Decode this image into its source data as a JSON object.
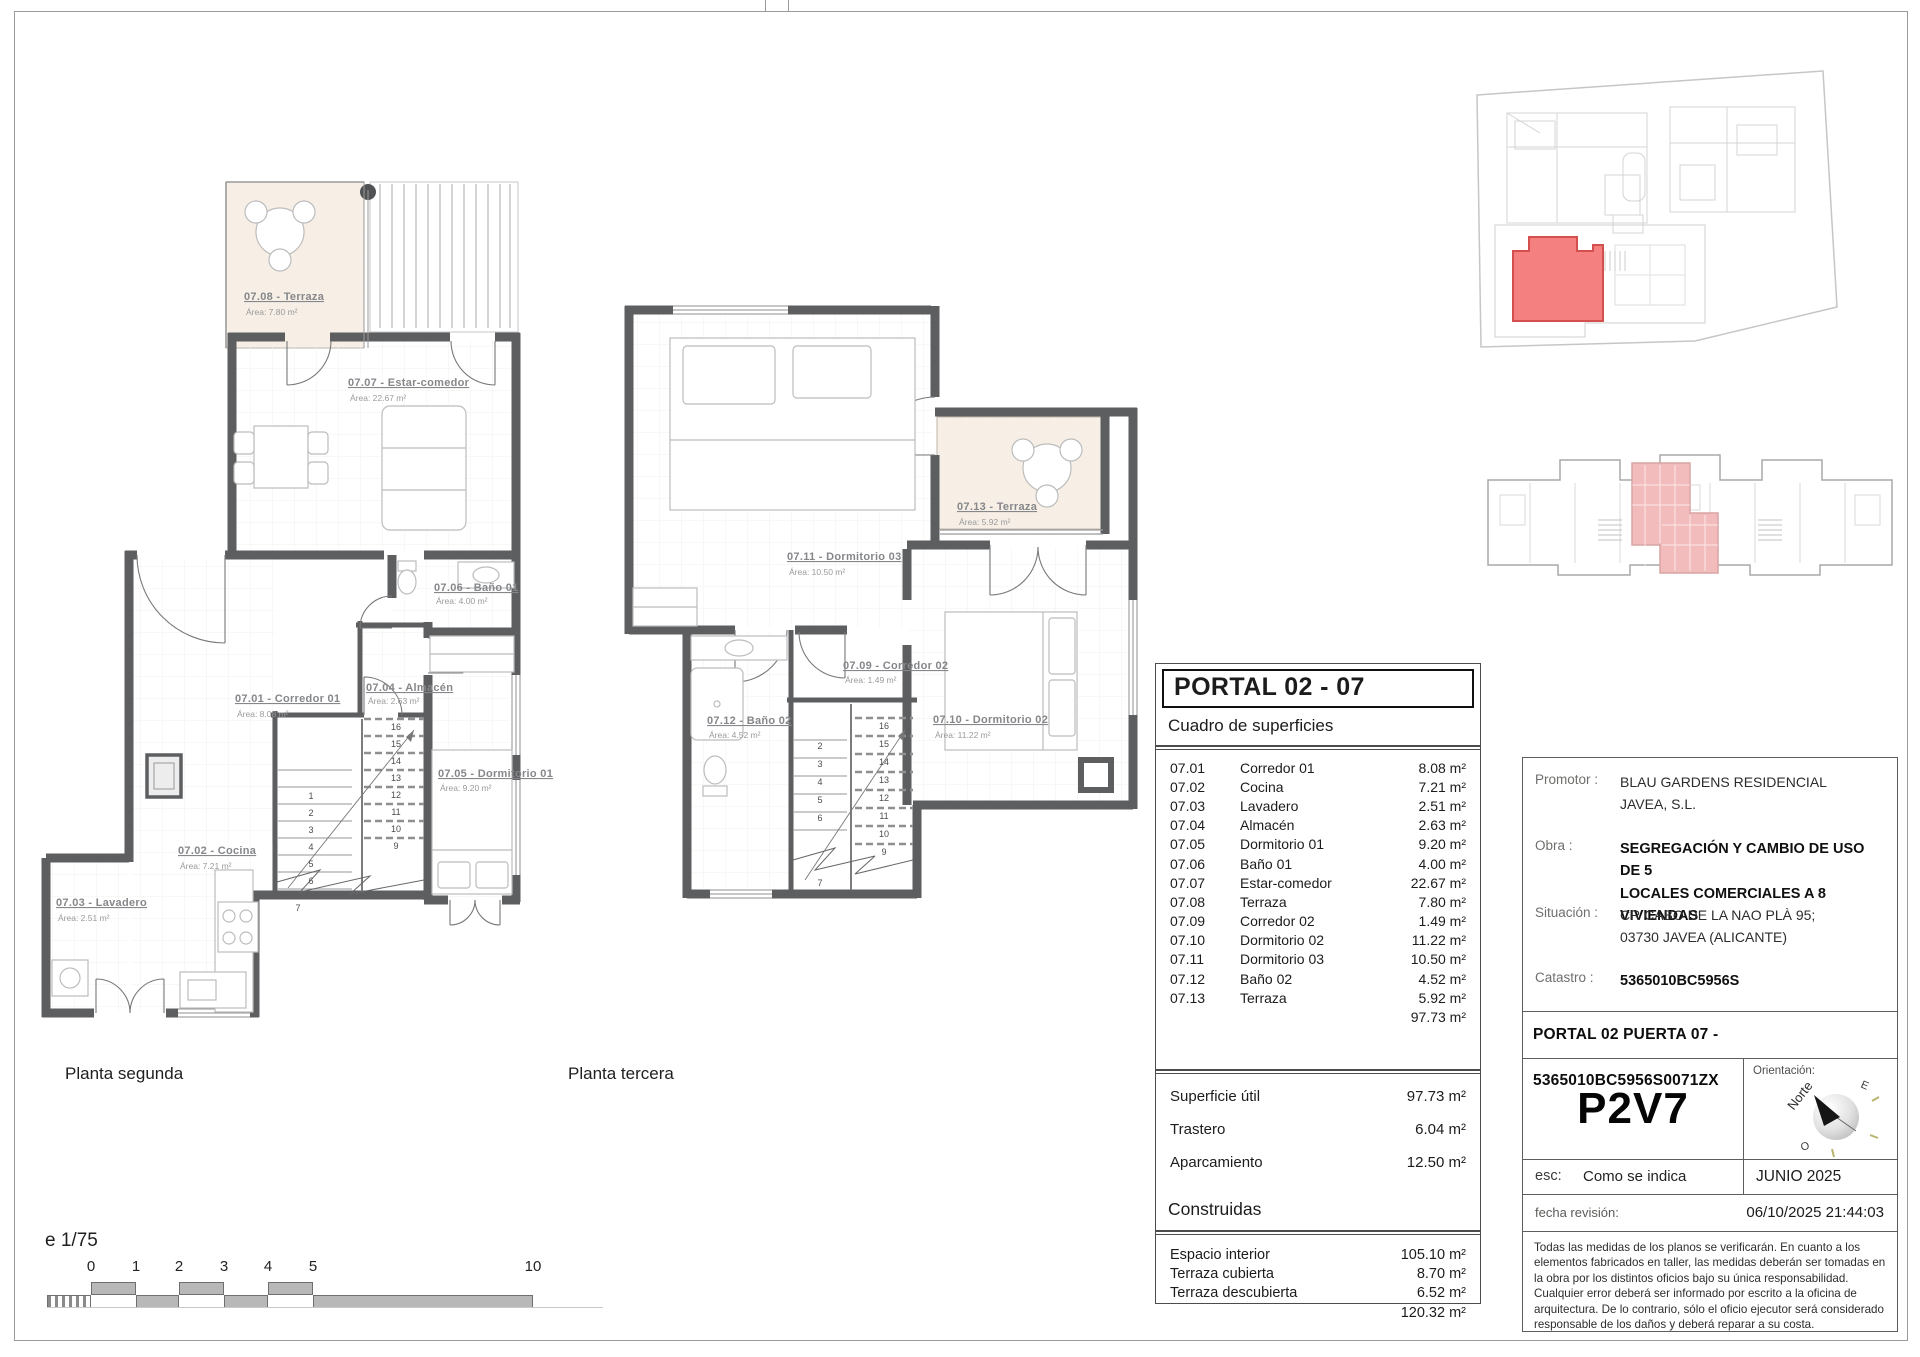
{
  "sheet": {
    "scale_note": "e 1/75"
  },
  "plans": {
    "planta2": {
      "caption": "Planta segunda",
      "rooms": [
        {
          "label": "07.08 - Terraza",
          "area": "Área: 7.80 m²"
        },
        {
          "label": "07.07 - Estar-comedor",
          "area": "Área: 22.67 m²"
        },
        {
          "label": "07.01 - Corredor 01",
          "area": "Área: 8.08 m²"
        },
        {
          "label": "07.04 - Almacén",
          "area": "Área: 2.63 m²"
        },
        {
          "label": "07.06 - Baño 01",
          "area": "Área: 4.00 m²"
        },
        {
          "label": "07.05 - Dormitorio 01",
          "area": "Área: 9.20 m²"
        },
        {
          "label": "07.02 - Cocina",
          "area": "Área: 7.21 m²"
        },
        {
          "label": "07.03 - Lavadero",
          "area": "Área: 2.51 m²"
        }
      ],
      "stairs_left": [
        "1",
        "2",
        "3",
        "4",
        "5",
        "6"
      ],
      "stairs_right": [
        "16",
        "15",
        "14",
        "13",
        "12",
        "11",
        "10",
        "9"
      ],
      "stair_bottom": "7"
    },
    "planta3": {
      "caption": "Planta tercera",
      "rooms": [
        {
          "label": "07.11 - Dormitorio 03",
          "area": "Área: 10.50 m²"
        },
        {
          "label": "07.13 - Terraza",
          "area": "Área: 5.92 m²"
        },
        {
          "label": "07.09 - Corredor 02",
          "area": "Área: 1.49 m²"
        },
        {
          "label": "07.12 - Baño 02",
          "area": "Área: 4.52 m²"
        },
        {
          "label": "07.10 - Dormitorio 02",
          "area": "Área: 11.22 m²"
        }
      ],
      "stairs_left": [
        "2",
        "3",
        "4",
        "5",
        "6"
      ],
      "stairs_right": [
        "16",
        "15",
        "14",
        "13",
        "12",
        "11",
        "10",
        "9"
      ],
      "stair_bottom": "7"
    }
  },
  "surfaces_table": {
    "title": "PORTAL 02 - 07",
    "subtitle": "Cuadro de superficies",
    "rows": [
      {
        "code": "07.01",
        "name": "Corredor 01",
        "value": "8.08 m²"
      },
      {
        "code": "07.02",
        "name": "Cocina",
        "value": "7.21 m²"
      },
      {
        "code": "07.03",
        "name": "Lavadero",
        "value": "2.51 m²"
      },
      {
        "code": "07.04",
        "name": "Almacén",
        "value": "2.63 m²"
      },
      {
        "code": "07.05",
        "name": "Dormitorio 01",
        "value": "9.20 m²"
      },
      {
        "code": "07.06",
        "name": "Baño 01",
        "value": "4.00 m²"
      },
      {
        "code": "07.07",
        "name": "Estar-comedor",
        "value": "22.67 m²"
      },
      {
        "code": "07.08",
        "name": "Terraza",
        "value": "7.80 m²"
      },
      {
        "code": "07.09",
        "name": "Corredor 02",
        "value": "1.49 m²"
      },
      {
        "code": "07.10",
        "name": "Dormitorio 02",
        "value": "11.22 m²"
      },
      {
        "code": "07.11",
        "name": "Dormitorio 03",
        "value": "10.50 m²"
      },
      {
        "code": "07.12",
        "name": "Baño 02",
        "value": "4.52 m²"
      },
      {
        "code": "07.13",
        "name": "Terraza",
        "value": "5.92 m²"
      }
    ],
    "useful_total": "97.73 m²",
    "summary": [
      {
        "name": "Superficie útil",
        "value": "97.73 m²"
      },
      {
        "name": "Trastero",
        "value": "6.04 m²"
      },
      {
        "name": "Aparcamiento",
        "value": "12.50 m²"
      }
    ],
    "built_header": "Construidas",
    "built_rows": [
      {
        "name": "Espacio interior",
        "value": "105.10 m²"
      },
      {
        "name": "Terraza cubierta",
        "value": "8.70 m²"
      },
      {
        "name": "Terraza descubierta",
        "value": "6.52 m²"
      }
    ],
    "built_total": "120.32 m²"
  },
  "title_block": {
    "promotor_label": "Promotor :",
    "promotor_line1": "BLAU GARDENS RESIDENCIAL",
    "promotor_line2": "JAVEA, S.L.",
    "obra_label": "Obra :",
    "obra_line1": "SEGREGACIÓN Y CAMBIO DE USO DE 5",
    "obra_line2": "LOCALES COMERCIALES A 8 VIVIENDAS",
    "situacion_label": "Situación :",
    "situacion_line1": "CR CABO DE LA NAO PLÀ 95;",
    "situacion_line2": "03730 JAVEA (ALICANTE)",
    "catastro_label": "Catastro :",
    "catastro_value": "5365010BC5956S",
    "portal_line": "PORTAL 02 PUERTA 07 - 5365010BC5956S0071ZX",
    "unit_code": "P2V7",
    "orientation_label": "Orientación:",
    "north_label": "Norte",
    "east_label": "E",
    "west_label": "O",
    "esc_label": "esc:",
    "esc_value": "Como se indica",
    "date": "JUNIO 2025",
    "revision_label": "fecha revisión:",
    "revision_value": "06/10/2025 21:44:03",
    "disclaimer": "Todas las medidas de los planos se verificarán. En cuanto a los elementos fabricados en taller, las medidas deberán ser tomadas en la obra por los distintos oficios bajo su única responsabilidad. Cualquier error deberá ser informado por escrito a la oficina de arquitectura. De lo contrario, sólo el oficio ejecutor será considerado responsable de los daños y deberá reparar a su costa."
  },
  "scalebar": {
    "marks": [
      "0",
      "1",
      "2",
      "3",
      "4",
      "5",
      "10"
    ]
  },
  "colors": {
    "wall": "#5d5e60",
    "terrace_fill": "#f7efe5",
    "highlight_red": "#f4807f",
    "highlight_pink": "#f3bcbc",
    "label_gray": "#85878a"
  }
}
